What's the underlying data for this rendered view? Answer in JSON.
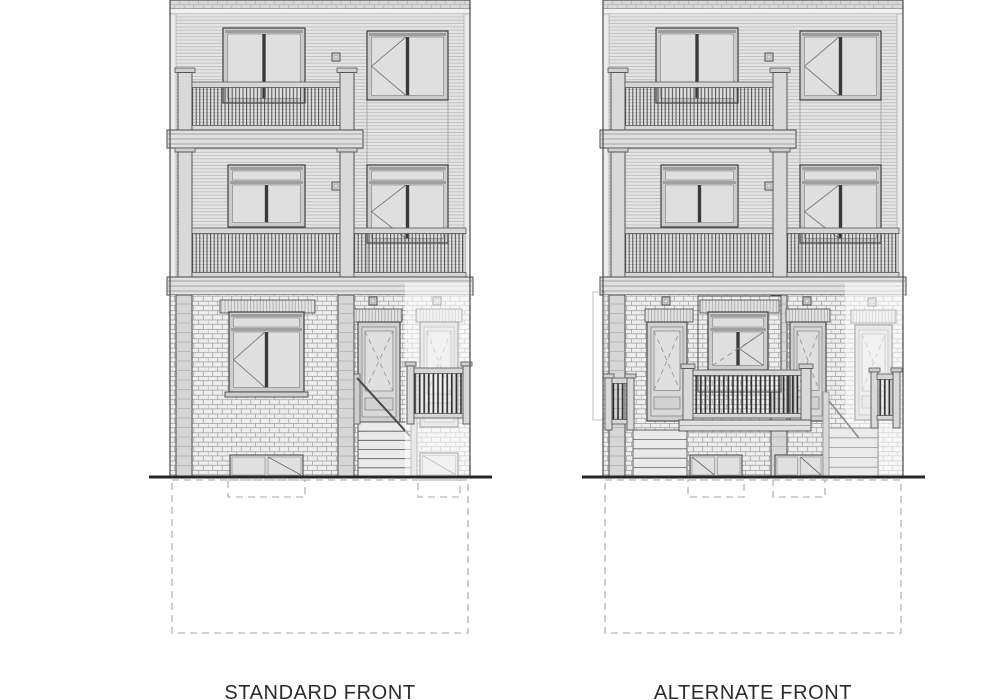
{
  "page": {
    "width": 991,
    "height": 700,
    "background": "#ffffff"
  },
  "drawing": {
    "type": "architectural-elevation-pair",
    "ground_y": 477,
    "buildings": [
      {
        "id": "standard-front",
        "label": "STANDARD FRONT",
        "variant": "standard",
        "x": 170,
        "width": 300,
        "storeys": 3,
        "features": [
          "clapboard siding upper floors",
          "brick ground floor",
          "two stacked balconies with railings",
          "stairwell bay casement windows",
          "entry door with front stair",
          "adjacent-unit phantom door with juliet railing",
          "basement windows with dashed wells",
          "dashed foundation outline"
        ]
      },
      {
        "id": "alternate-front",
        "label": "ALTERNATE FRONT",
        "variant": "alternate",
        "x": 603,
        "width": 300,
        "storeys": 3,
        "features": [
          "clapboard siding upper floors",
          "brick ground floor",
          "two stacked balconies with railings",
          "twin entry doors flanking centre window",
          "front porch railing with side stairs",
          "adjacent-unit phantom door with juliet railing",
          "basement windows with dashed wells",
          "dashed foundation outline"
        ]
      }
    ],
    "label_y": 682,
    "font_size": 20,
    "colors": {
      "paper": "#ffffff",
      "line_dark": "#3f3f3f",
      "line_mid": "#7a7a7a",
      "siding_bg": "#e4e4e4",
      "siding_line": "#b9b9b9",
      "brick_bg": "#eeeeee",
      "brick_line": "#9c9c9c",
      "parapet": "#d8d8d8",
      "trim": "#f1f1f1",
      "frame": "#cccccc",
      "pane": "#dfdfdf",
      "mullion": "#3a3a3a",
      "post": "#d9d9d9",
      "fascia": "#e0e0e0",
      "baluster": "#4a4a4a",
      "baluster_dark": "#2f2f2f",
      "stair": "#eaeaea",
      "lintel": "#e3e3e3",
      "ground": "#262626",
      "dashed": "#a6a6a6",
      "phantom": "rgba(255,255,255,0.55)",
      "label": "#2b2b2b"
    }
  }
}
